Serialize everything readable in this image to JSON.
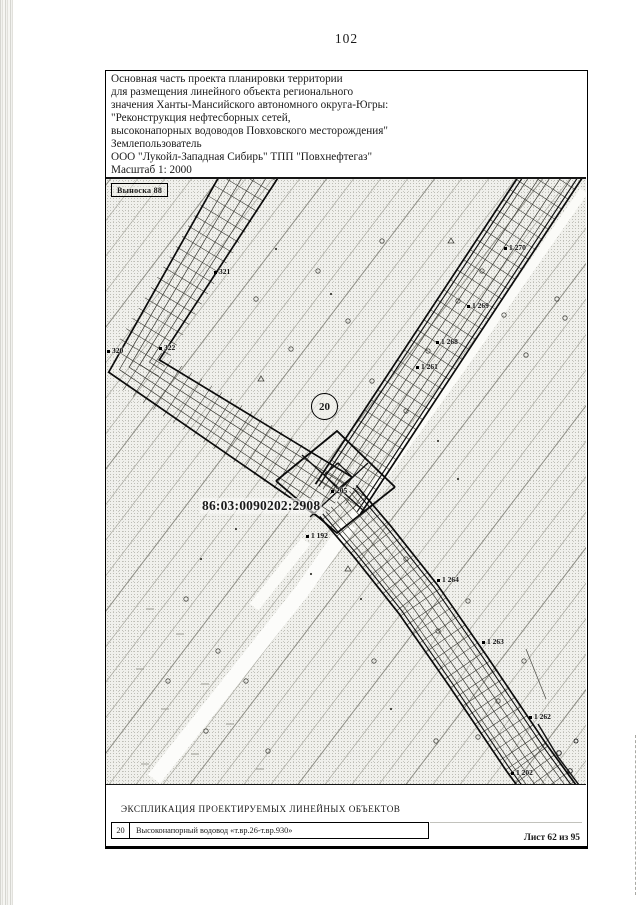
{
  "page": {
    "number": "102",
    "sheet_label": "Лист 62 из 95"
  },
  "header": {
    "lines": [
      "Основная часть проекта планировки территории",
      "для размещения линейного объекта регионального",
      "значения Ханты-Мансийского автономного округа-Югры:",
      "\"Реконструкция нефтесборных сетей,",
      "высоконапорных водоводов Повховского месторождения\"",
      "Землепользователь",
      "ООО \"Лукойл-Западная Сибирь\" ТПП \"Повхнефтегаз\"",
      "Масштаб 1: 2000"
    ]
  },
  "map": {
    "callout_label": "Выноска 88",
    "cadastral_number": "86:03:0090202:2908",
    "route_number": "20",
    "point_labels": [
      {
        "text": "321",
        "x": 108,
        "y": 88
      },
      {
        "text": "322",
        "x": 53,
        "y": 164
      },
      {
        "text": "320",
        "x": 1,
        "y": 167
      },
      {
        "text": "1 270",
        "x": 398,
        "y": 64
      },
      {
        "text": "1 269",
        "x": 361,
        "y": 122
      },
      {
        "text": "1 268",
        "x": 330,
        "y": 158
      },
      {
        "text": "1 261",
        "x": 310,
        "y": 183
      },
      {
        "text": "205",
        "x": 225,
        "y": 307
      },
      {
        "text": "1 192",
        "x": 200,
        "y": 352
      },
      {
        "text": "1 264",
        "x": 331,
        "y": 396
      },
      {
        "text": "1 263",
        "x": 376,
        "y": 458
      },
      {
        "text": "1 262",
        "x": 423,
        "y": 533
      },
      {
        "text": "1 202",
        "x": 405,
        "y": 589
      }
    ]
  },
  "legend": {
    "title": "ЭКСПЛИКАЦИЯ ПРОЕКТИРУЕМЫХ ЛИНЕЙНЫХ ОБЪЕКТОВ",
    "rows": [
      {
        "code": "20",
        "name": "Высоконапорный водовод «т.вр.26-т.вр.930»"
      }
    ]
  }
}
